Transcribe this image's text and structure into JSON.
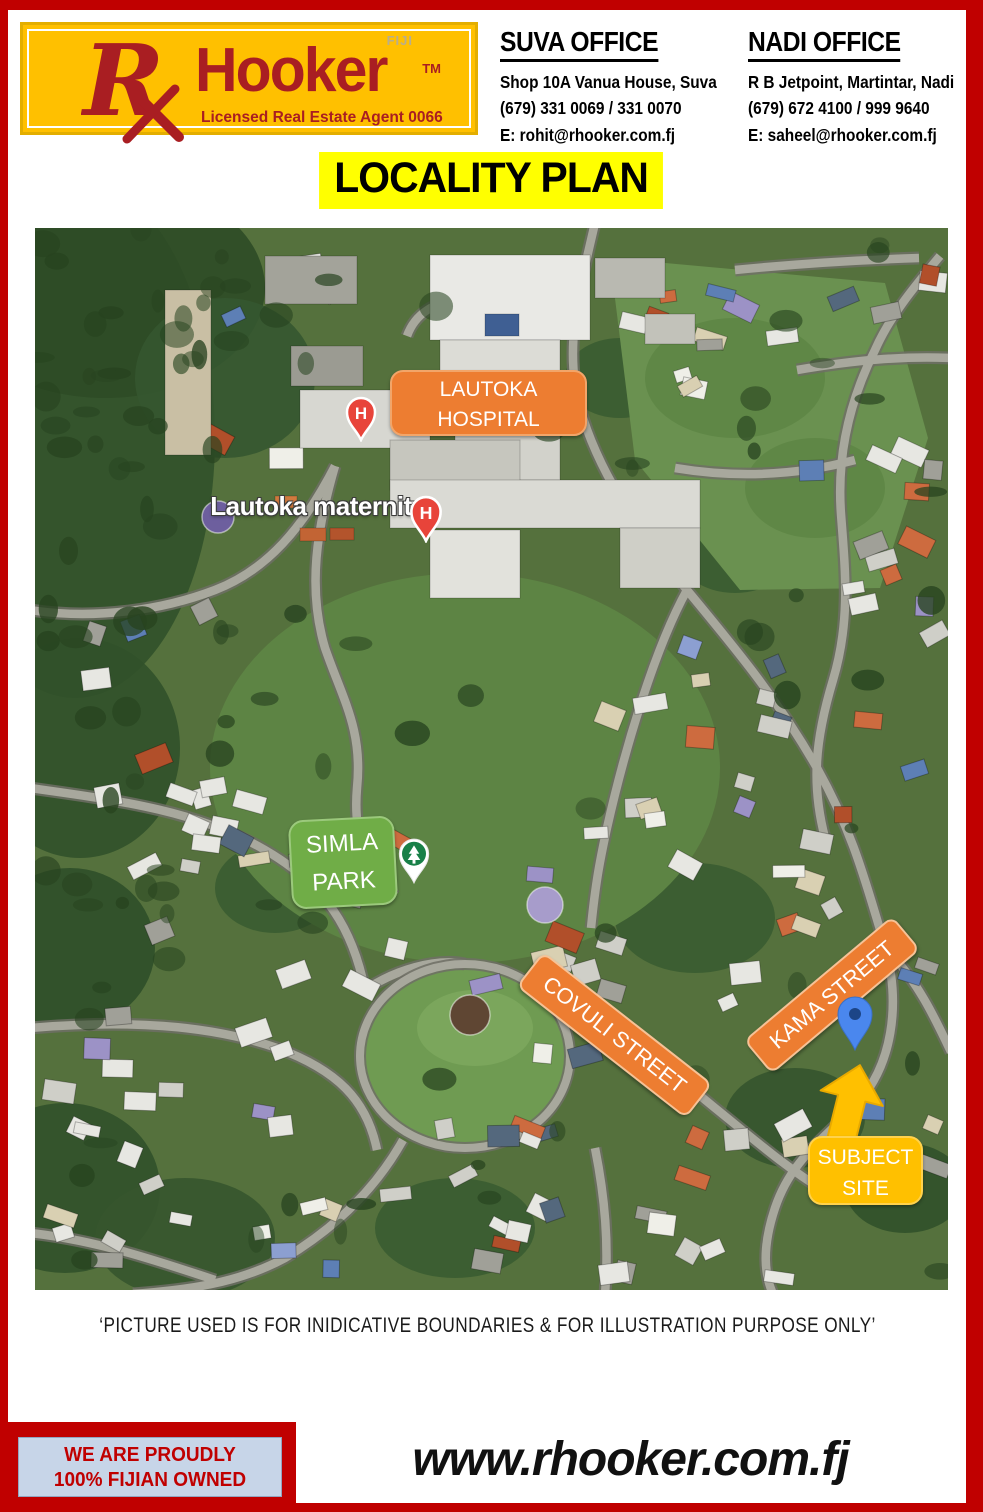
{
  "colors": {
    "red": "#C00000",
    "gold": "#FFC000",
    "highlight": "#FFFF00",
    "brand": "#A91E22",
    "orange": "#ED7D31",
    "green": "#70AD47"
  },
  "header": {
    "logo": {
      "brand": "Hooker",
      "tm": "TM",
      "country": "FIJI",
      "tagline": "Licensed Real Estate Agent 0066"
    },
    "suva": {
      "title": "SUVA OFFICE",
      "address": "Shop 10A Vanua House, Suva",
      "phone": "(679) 331 0069 / 331 0070",
      "email": "E: rohit@rhooker.com.fj"
    },
    "nadi": {
      "title": "NADI OFFICE",
      "address": "R B Jetpoint, Martintar, Nadi",
      "phone": "(679) 672 4100 / 999 9640",
      "email": "E: saheel@rhooker.com.fj"
    }
  },
  "title": "LOCALITY PLAN",
  "map": {
    "hospital_label": {
      "line1": "LAUTOKA",
      "line2": "HOSPITAL"
    },
    "maternity_label": "Lautoka maternity",
    "park_label": {
      "line1": "SIMLA",
      "line2": "PARK"
    },
    "covuli_label": "COVULI STREET",
    "kama_label": "KAMA STREET",
    "site_label": {
      "line1": "SUBJECT",
      "line2": "SITE"
    },
    "h_marker": "H"
  },
  "disclaimer": "‘PICTURE USED IS FOR INIDICATIVE BOUNDARIES & FOR ILLUSTRATION PURPOSE ONLY’",
  "footer": {
    "badge_line1": "WE ARE PROUDLY",
    "badge_line2": "100%  FIJIAN OWNED",
    "website": "www.rhooker.com.fj"
  }
}
